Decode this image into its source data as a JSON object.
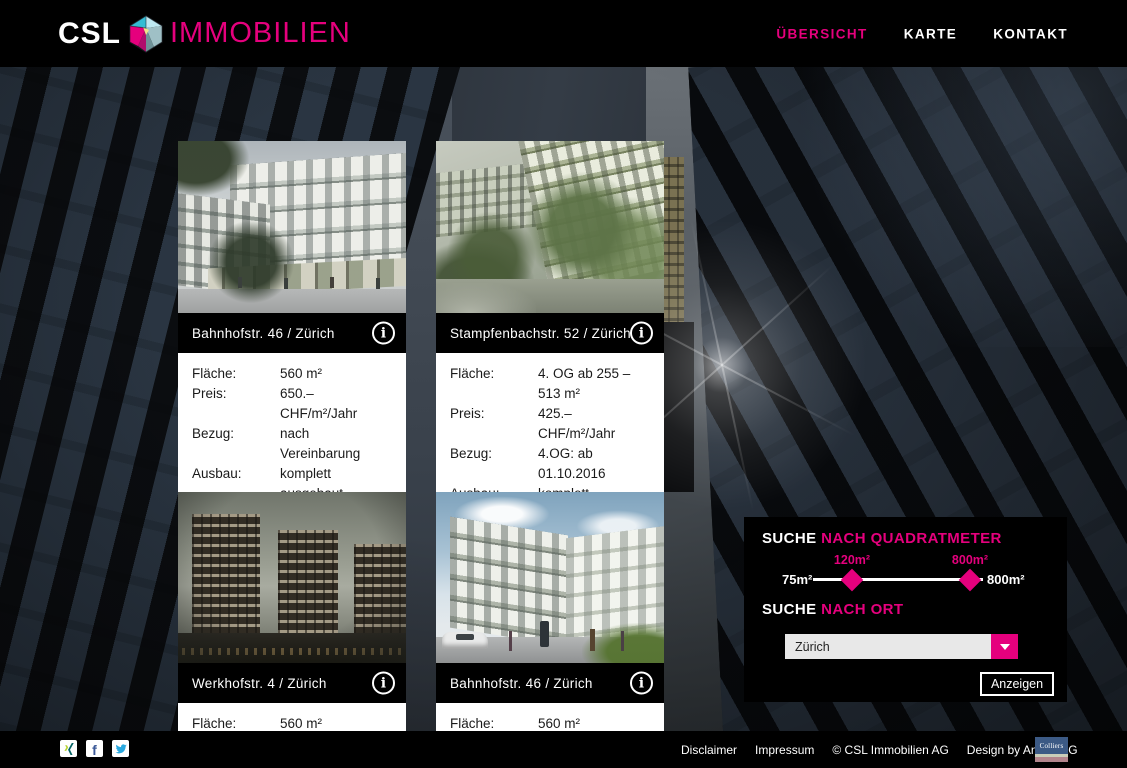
{
  "brand": {
    "csl": "CSL",
    "immobilien": "IMMOBILIEN"
  },
  "nav": [
    {
      "label": "ÜBERSICHT",
      "active": true
    },
    {
      "label": "KARTE",
      "active": false
    },
    {
      "label": "KONTAKT",
      "active": false
    }
  ],
  "icons": {
    "info": "i"
  },
  "cards": [
    {
      "title": "Bahnhofstr. 46 / Zürich",
      "rows": [
        {
          "label": "Fläche:",
          "value": "560 m²"
        },
        {
          "label": "Preis:",
          "value": "650.– CHF/m²/Jahr"
        },
        {
          "label": "Bezug:",
          "value": "nach Vereinbarung"
        },
        {
          "label": "Ausbau:",
          "value": "komplett ausgebaut"
        }
      ]
    },
    {
      "title": "Stampfenbachstr. 52  / Zürich",
      "rows": [
        {
          "label": "Fläche:",
          "value": "4. OG ab 255 – 513 m²"
        },
        {
          "label": "Preis:",
          "value": "425.– CHF/m²/Jahr"
        },
        {
          "label": "Bezug:",
          "value": "4.OG: ab 01.10.2016"
        },
        {
          "label": "Ausbau:",
          "value": "komplett ausgebaut"
        }
      ]
    },
    {
      "title": "Werkhofstr. 4 / Zürich",
      "rows": [
        {
          "label": "Fläche:",
          "value": "560 m²"
        }
      ]
    },
    {
      "title": "Bahnhofstr. 46 / Zürich",
      "rows": [
        {
          "label": "Fläche:",
          "value": "560 m²"
        }
      ]
    }
  ],
  "search": {
    "suche": "SUCHE",
    "nach_quadratmeter": "NACH QUADRATMETER",
    "nach_ort": "NACH ORT",
    "slider": {
      "min": "75m²",
      "max": "800m²",
      "low": "120m²",
      "high": "800m²"
    },
    "dropdown_value": "Zürich",
    "submit": "Anzeigen"
  },
  "footer": {
    "links": [
      "Disclaimer",
      "Impressum",
      "© CSL Immobilien AG",
      "Design by Andeo AG"
    ],
    "social": [
      "xing",
      "facebook",
      "twitter"
    ],
    "facebook_glyph": "f",
    "colliers": "Colliers"
  },
  "colors": {
    "accent_pink": "#e5007d",
    "facebook_blue": "#3b5998",
    "twitter_blue": "#2aa9e0",
    "xing_teal": "#056465",
    "xing_lime": "#b7d332",
    "colliers_blue": "#3c5a85"
  }
}
